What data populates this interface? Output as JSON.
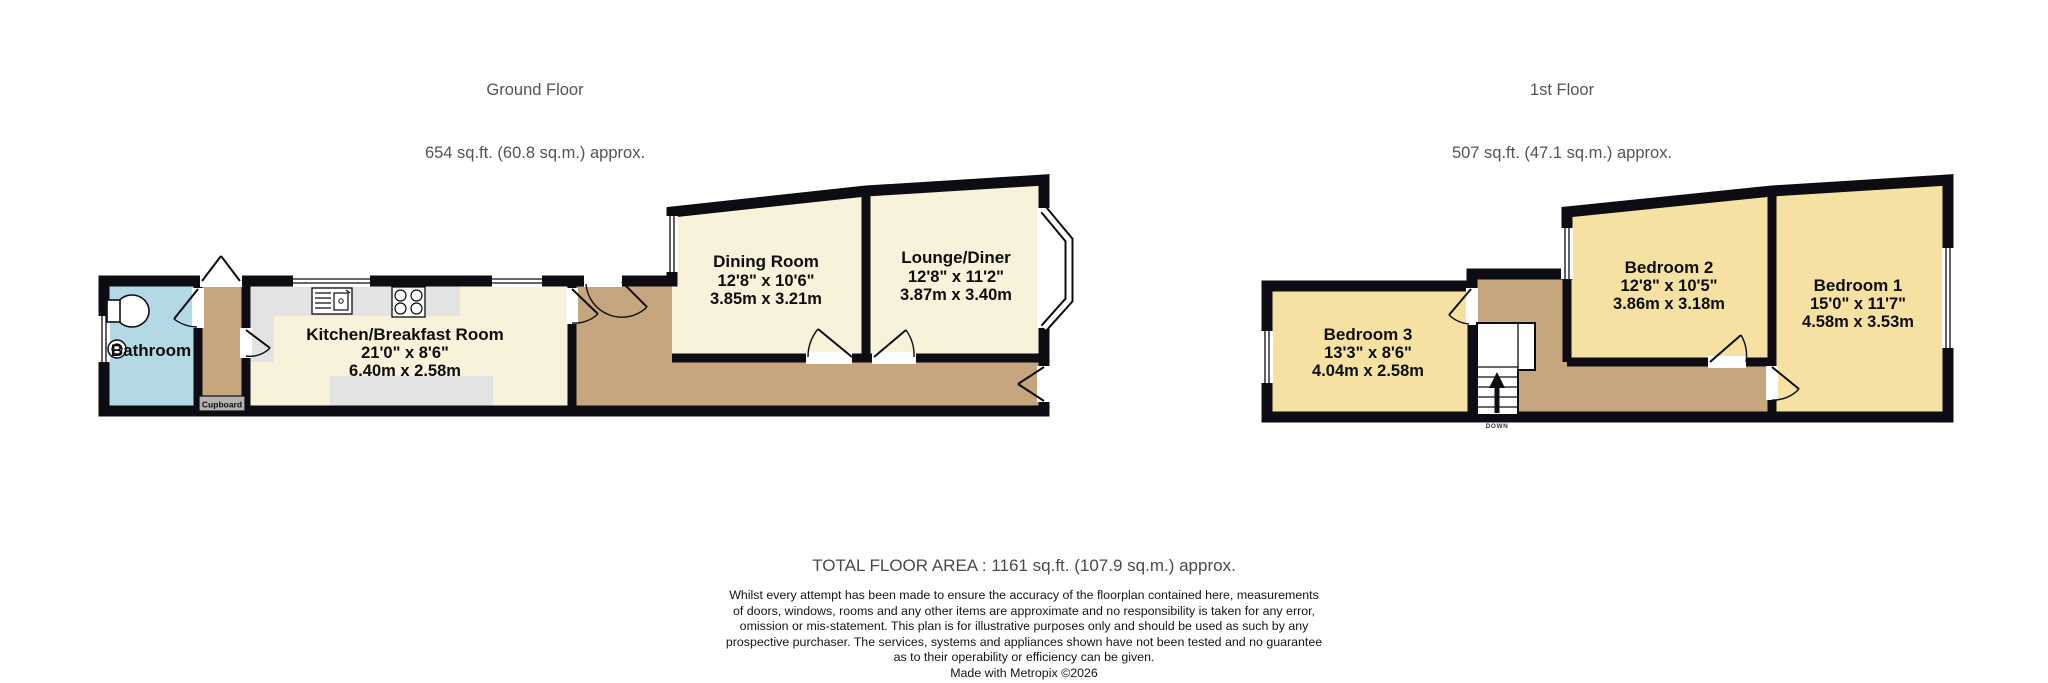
{
  "ground_floor": {
    "title": "Ground Floor",
    "area": "654 sq.ft. (60.8 sq.m.) approx.",
    "rooms": {
      "bathroom": {
        "name": "Bathroom"
      },
      "cupboard": {
        "name": "Cupboard"
      },
      "kitchen": {
        "name": "Kitchen/Breakfast Room",
        "dims_imperial": "21'0\"  x 8'6\"",
        "dims_metric": "6.40m  x 2.58m"
      },
      "dining": {
        "name": "Dining Room",
        "dims_imperial": "12'8\"  x 10'6\"",
        "dims_metric": "3.85m  x 3.21m"
      },
      "lounge": {
        "name": "Lounge/Diner",
        "dims_imperial": "12'8\"  x 11'2\"",
        "dims_metric": "3.87m  x 3.40m"
      }
    }
  },
  "first_floor": {
    "title": "1st Floor",
    "area": "507 sq.ft. (47.1 sq.m.) approx.",
    "rooms": {
      "bedroom3": {
        "name": "Bedroom 3",
        "dims_imperial": "13'3\"  x 8'6\"",
        "dims_metric": "4.04m  x 2.58m"
      },
      "bedroom2": {
        "name": "Bedroom 2",
        "dims_imperial": "12'8\"  x 10'5\"",
        "dims_metric": "3.86m  x 3.18m"
      },
      "bedroom1": {
        "name": "Bedroom 1",
        "dims_imperial": "15'0\"  x 11'7\"",
        "dims_metric": "4.58m  x 3.53m"
      }
    },
    "stairs_label": "DOWN"
  },
  "footer": {
    "total": "TOTAL FLOOR AREA : 1161 sq.ft. (107.9 sq.m.) approx.",
    "disclaimer_lines": [
      "Whilst every attempt has been made to ensure the accuracy of the floorplan contained here, measurements",
      "of doors, windows, rooms and any other items are approximate and no responsibility is taken for any error,",
      "omission or mis-statement. This plan is for illustrative purposes only and should be used as such by any",
      "prospective purchaser. The services, systems and appliances shown have not been tested and no guarantee",
      "as to their operability or efficiency can be given."
    ],
    "credit": "Made with Metropix ©2026"
  },
  "colors": {
    "wall": "#0c0c12",
    "bathroom": "#b2d9e5",
    "room_cream": "#f8f2da",
    "bedroom_yellow": "#f5e2a2",
    "corridor_tan": "#c5a67e",
    "counter_gray": "#e3e3e3",
    "cupboard_gray": "#b3b3b3"
  }
}
